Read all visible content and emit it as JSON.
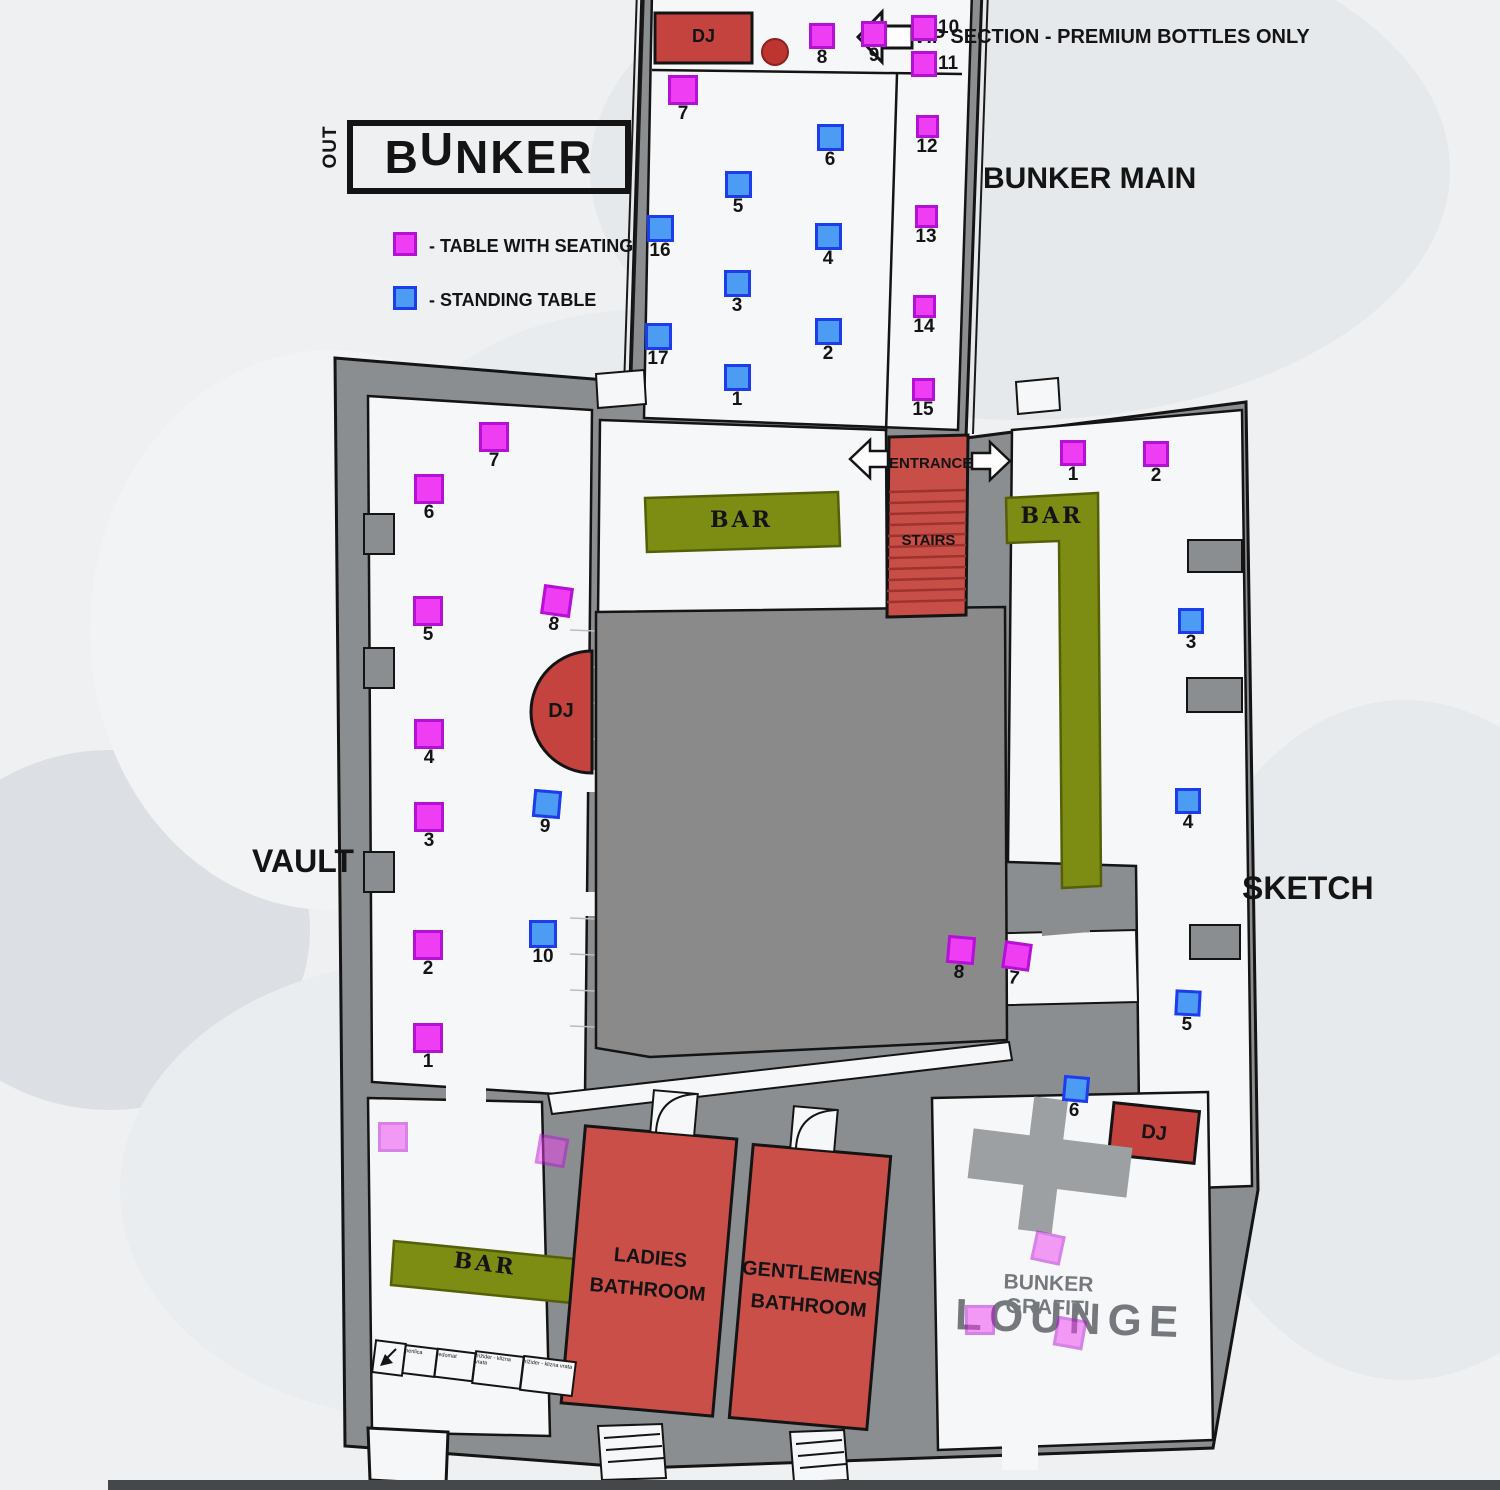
{
  "logo": {
    "prefix": "OUT",
    "main": "BUNKER"
  },
  "legend": {
    "seating_label": "- TABLE WITH SEATING",
    "standing_label": "- STANDING TABLE"
  },
  "labels": {
    "vip_note": "VIP SECTION - PREMIUM BOTTLES ONLY",
    "bunker_main": "BUNKER MAIN",
    "vault": "VAULT",
    "sketch": "SKETCH",
    "entrance": "ENTRANCE",
    "stairs": "STAIRS",
    "bar": "BAR",
    "dj": "DJ",
    "ladies_bathroom": "LADIES\nBATHROOM",
    "gentlemens_bathroom": "GENTLEMENS\nBATHROOM",
    "lounge_title": "BUNKER GRAFITI",
    "lounge_name": "LOUNGE"
  },
  "utility_labels": [
    "perilica",
    "ledomat",
    "frižider - klizna vrata",
    "frižider - klizna vrata"
  ],
  "colors": {
    "seating_fill": "#ee3df2",
    "seating_border": "#b511d6",
    "standing_fill": "#4d9cf4",
    "standing_border": "#1d3cec",
    "bar_green": "#7d8d13",
    "stairs_red": "#c84e48",
    "dj_red": "#c4433e",
    "bathroom_red": "#cb4f49",
    "wall_gray": "#8b8e90"
  },
  "tables": [
    {
      "n": "8",
      "t": "seat",
      "x": 822,
      "y": 36,
      "s": 26,
      "sec": "bunker-main"
    },
    {
      "n": "9",
      "t": "seat",
      "x": 874,
      "y": 34,
      "s": 26,
      "sec": "bunker-main"
    },
    {
      "n": "10",
      "t": "seat",
      "x": 924,
      "y": 28,
      "s": 26,
      "lp": "r",
      "sec": "bunker-main"
    },
    {
      "n": "11",
      "t": "seat",
      "x": 924,
      "y": 64,
      "s": 26,
      "lp": "r",
      "sec": "bunker-main"
    },
    {
      "n": "7",
      "t": "seat",
      "x": 683,
      "y": 90,
      "s": 30,
      "sec": "bunker-main"
    },
    {
      "n": "12",
      "t": "seat",
      "x": 927,
      "y": 126,
      "s": 23,
      "sec": "bunker-main"
    },
    {
      "n": "13",
      "t": "seat",
      "x": 926,
      "y": 216,
      "s": 23,
      "sec": "bunker-main"
    },
    {
      "n": "14",
      "t": "seat",
      "x": 924,
      "y": 306,
      "s": 23,
      "sec": "bunker-main"
    },
    {
      "n": "15",
      "t": "seat",
      "x": 923,
      "y": 389,
      "s": 23,
      "sec": "bunker-main"
    },
    {
      "n": "6",
      "t": "stand",
      "x": 830,
      "y": 137,
      "s": 27,
      "sec": "bunker-main"
    },
    {
      "n": "5",
      "t": "stand",
      "x": 738,
      "y": 184,
      "s": 27,
      "sec": "bunker-main"
    },
    {
      "n": "16",
      "t": "stand",
      "x": 660,
      "y": 228,
      "s": 27,
      "sec": "bunker-main"
    },
    {
      "n": "4",
      "t": "stand",
      "x": 828,
      "y": 236,
      "s": 27,
      "sec": "bunker-main"
    },
    {
      "n": "3",
      "t": "stand",
      "x": 737,
      "y": 283,
      "s": 27,
      "sec": "bunker-main"
    },
    {
      "n": "2",
      "t": "stand",
      "x": 828,
      "y": 331,
      "s": 27,
      "sec": "bunker-main"
    },
    {
      "n": "17",
      "t": "stand",
      "x": 658,
      "y": 336,
      "s": 27,
      "sec": "bunker-main"
    },
    {
      "n": "1",
      "t": "stand",
      "x": 737,
      "y": 377,
      "s": 27,
      "sec": "bunker-main"
    },
    {
      "n": "7",
      "t": "seat",
      "x": 494,
      "y": 437,
      "s": 30,
      "sec": "vault"
    },
    {
      "n": "6",
      "t": "seat",
      "x": 429,
      "y": 489,
      "s": 30,
      "sec": "vault"
    },
    {
      "n": "5",
      "t": "seat",
      "x": 428,
      "y": 611,
      "s": 30,
      "sec": "vault"
    },
    {
      "n": "8",
      "t": "seat",
      "x": 557,
      "y": 601,
      "s": 30,
      "r": 8,
      "sec": "vault"
    },
    {
      "n": "4",
      "t": "seat",
      "x": 429,
      "y": 734,
      "s": 30,
      "sec": "vault"
    },
    {
      "n": "3",
      "t": "seat",
      "x": 429,
      "y": 817,
      "s": 30,
      "sec": "vault"
    },
    {
      "n": "2",
      "t": "seat",
      "x": 428,
      "y": 945,
      "s": 30,
      "sec": "vault"
    },
    {
      "n": "1",
      "t": "seat",
      "x": 428,
      "y": 1038,
      "s": 30,
      "sec": "vault"
    },
    {
      "n": "9",
      "t": "stand",
      "x": 547,
      "y": 804,
      "s": 28,
      "r": 5,
      "sec": "vault"
    },
    {
      "n": "10",
      "t": "stand",
      "x": 543,
      "y": 934,
      "s": 28,
      "sec": "vault"
    },
    {
      "n": "1",
      "t": "seat",
      "x": 1073,
      "y": 453,
      "s": 26,
      "sec": "sketch"
    },
    {
      "n": "2",
      "t": "seat",
      "x": 1156,
      "y": 454,
      "s": 26,
      "sec": "sketch"
    },
    {
      "n": "3",
      "t": "stand",
      "x": 1191,
      "y": 621,
      "s": 26,
      "sec": "sketch"
    },
    {
      "n": "4",
      "t": "stand",
      "x": 1188,
      "y": 801,
      "s": 26,
      "sec": "sketch"
    },
    {
      "n": "5",
      "t": "stand",
      "x": 1188,
      "y": 1003,
      "s": 26,
      "r": 3,
      "sec": "sketch"
    },
    {
      "n": "6",
      "t": "stand",
      "x": 1076,
      "y": 1089,
      "s": 26,
      "r": 5,
      "sec": "sketch"
    },
    {
      "n": "7",
      "t": "seat",
      "x": 1017,
      "y": 956,
      "s": 28,
      "r": 8,
      "sec": "sketch"
    },
    {
      "n": "8",
      "t": "seat",
      "x": 961,
      "y": 950,
      "s": 28,
      "r": 5,
      "sec": "sketch"
    }
  ],
  "faded_tables": [
    {
      "x": 1048,
      "y": 1248,
      "s": 30,
      "r": 12,
      "sec": "lounge"
    },
    {
      "x": 980,
      "y": 1320,
      "s": 30,
      "r": 0,
      "sec": "lounge"
    },
    {
      "x": 1070,
      "y": 1333,
      "s": 30,
      "r": 10,
      "sec": "lounge"
    },
    {
      "x": 393,
      "y": 1137,
      "s": 30,
      "r": 0,
      "sec": "bottom-left"
    },
    {
      "x": 552,
      "y": 1151,
      "s": 30,
      "r": 10,
      "sec": "bottom-left"
    }
  ]
}
